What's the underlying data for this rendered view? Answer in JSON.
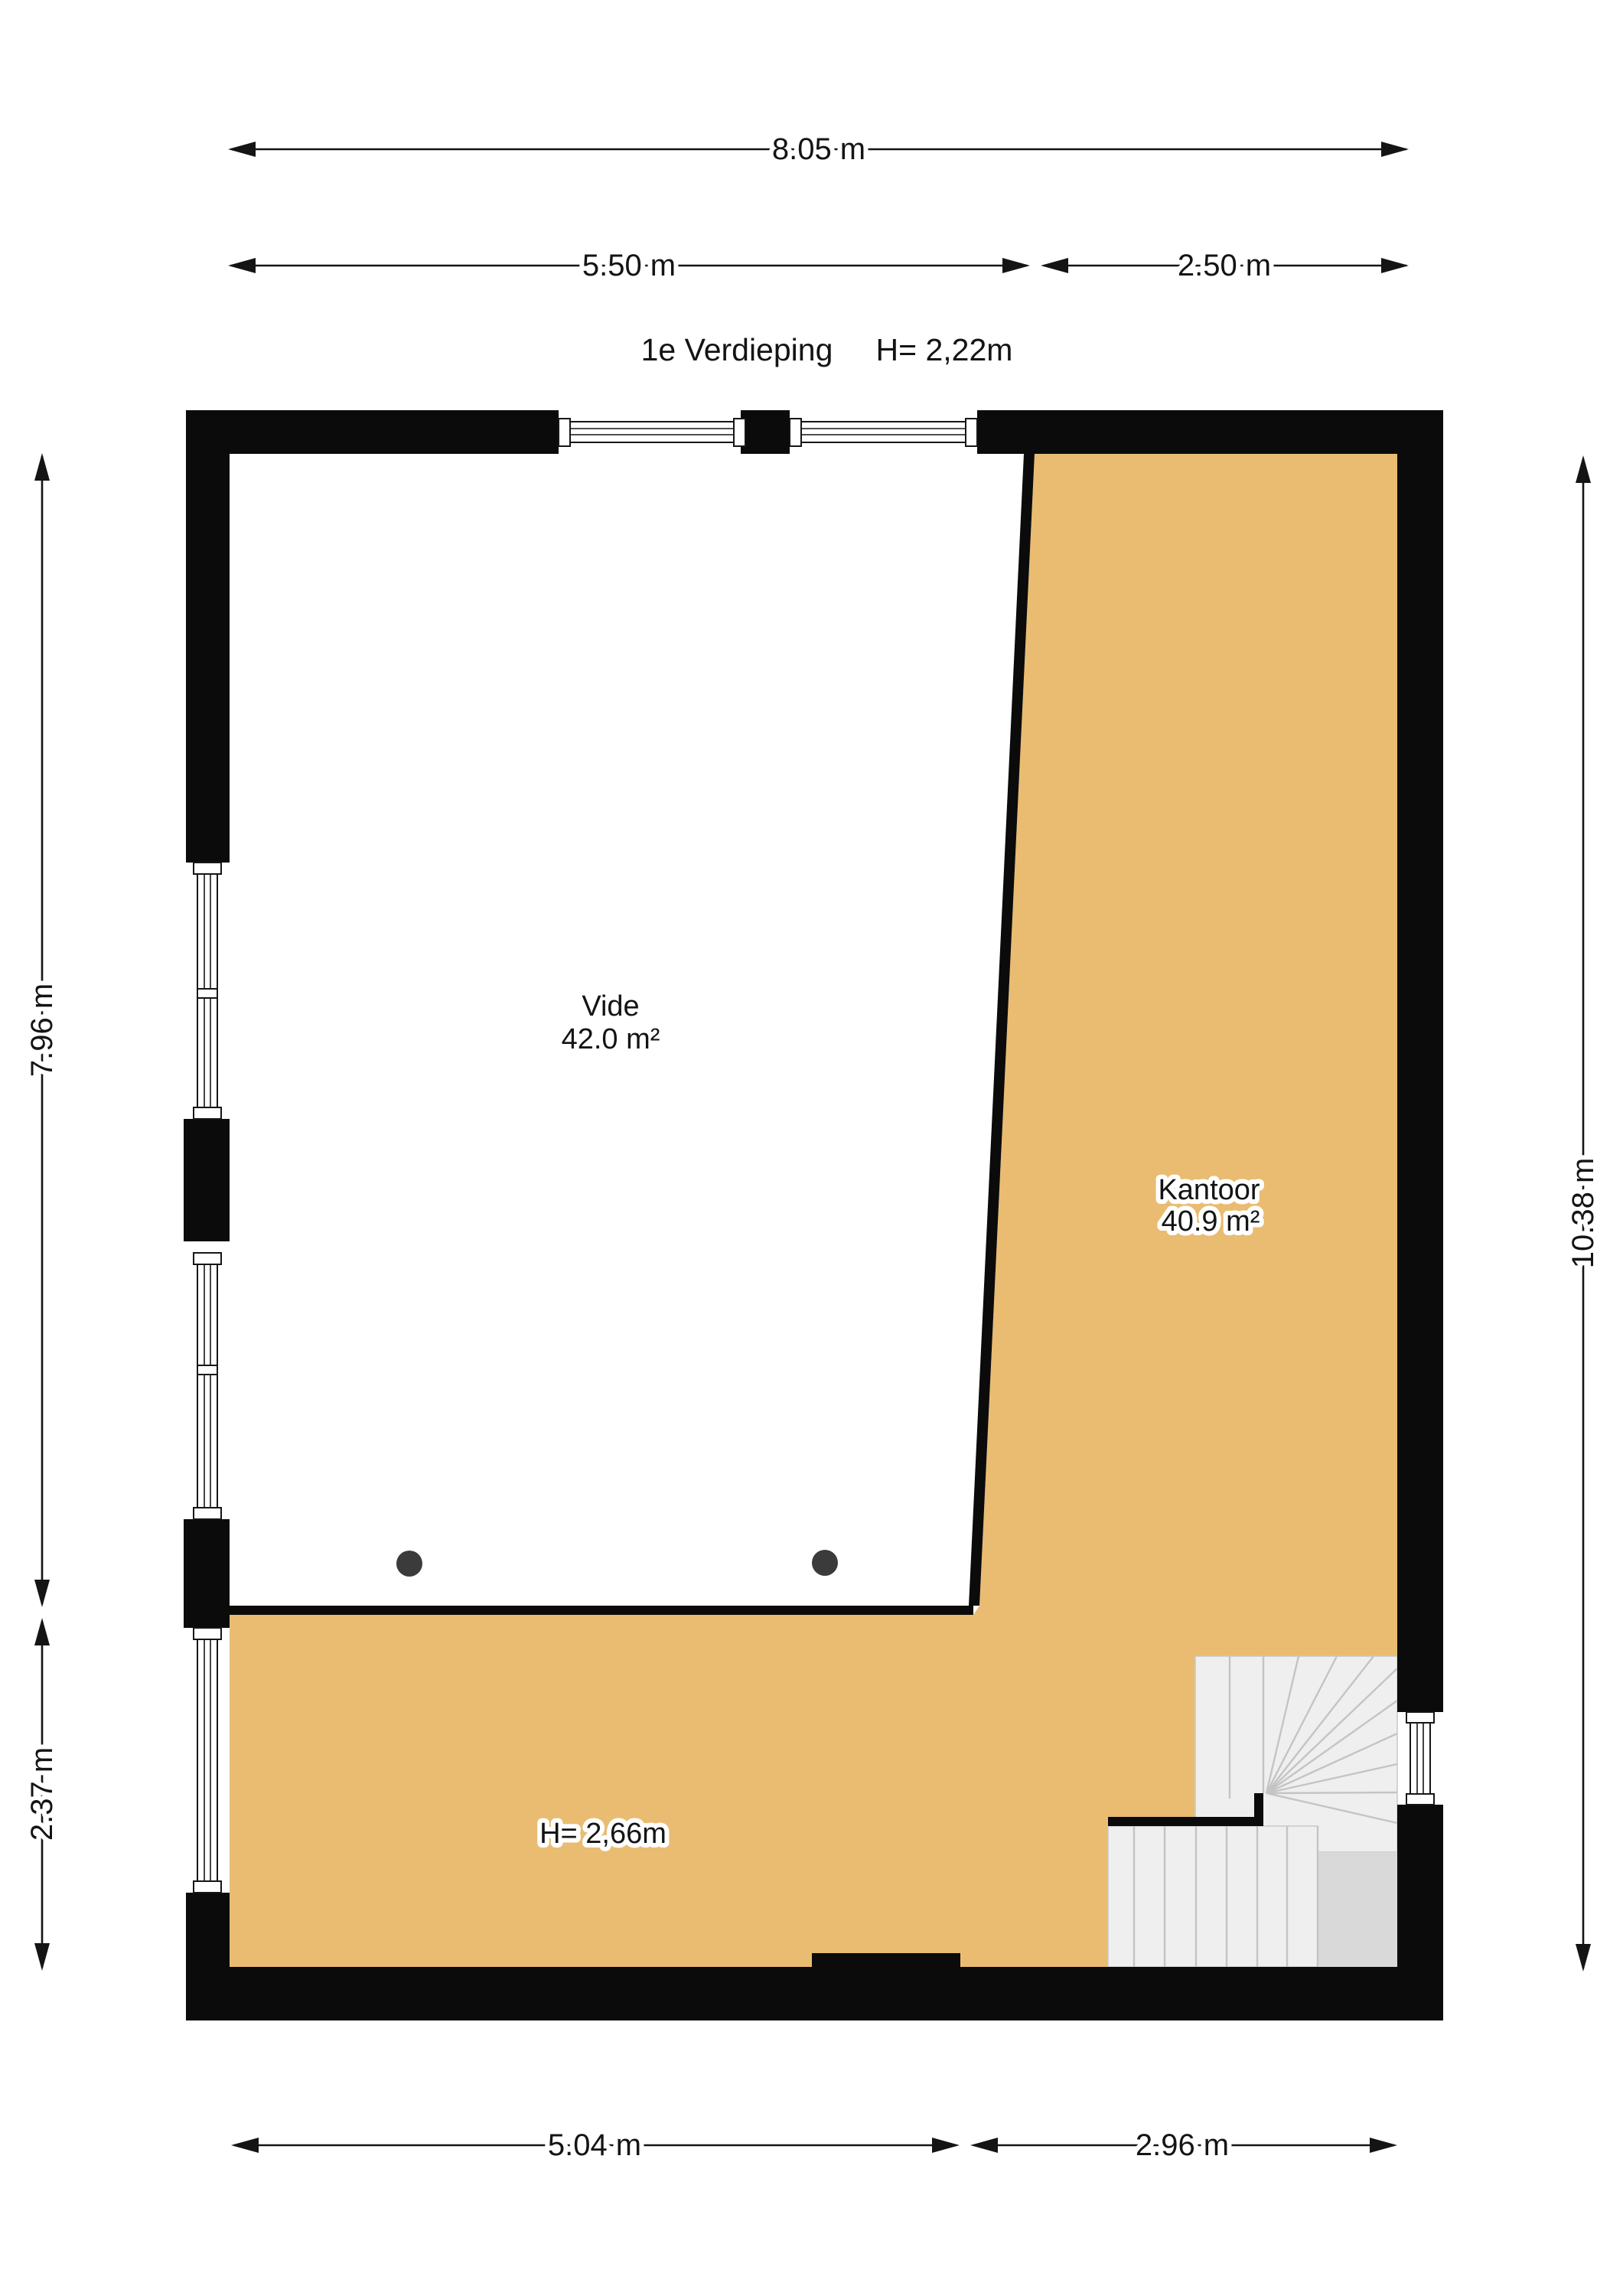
{
  "header": {
    "floor_name": "1e Verdieping",
    "floor_height": "H= 2,22m"
  },
  "rooms": {
    "vide": {
      "name": "Vide",
      "area": "42.0 m²"
    },
    "kantoor": {
      "name": "Kantoor",
      "area": "40.9 m²"
    }
  },
  "annotations": {
    "lower_area_height": "H= 2,66m"
  },
  "dimensions": {
    "top_total": "8.05 m",
    "top_left": "5.50 m",
    "top_right": "2.50 m",
    "left_upper": "7.96 m",
    "left_lower": "2.37 m",
    "right_total": "10.38 m",
    "bottom_left": "5.04 m",
    "bottom_right": "2.96 m"
  },
  "colors": {
    "wall": "#0b0b0b",
    "room_fill": "#e9bc72",
    "stair_fill": "#efefef",
    "stair_landing": "#d9d9d9",
    "stair_line": "#c4c4c4",
    "column_dot": "#3b3b3b",
    "dimension_line": "#141414"
  }
}
